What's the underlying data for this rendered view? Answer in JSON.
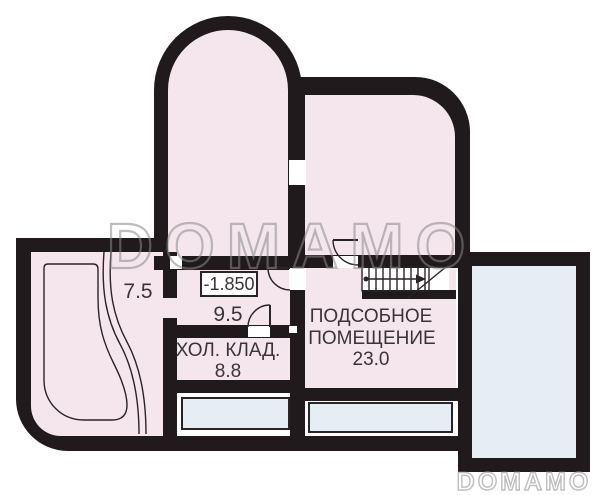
{
  "plan": {
    "type": "basement-floor-plan",
    "elevation_mark": "-1.850",
    "rooms": [
      {
        "id": "room-7-5",
        "area": "7.5"
      },
      {
        "id": "hall",
        "area": "9.5"
      },
      {
        "id": "cold-storage",
        "label": "ХОЛ. КЛАД.",
        "area": "8.8"
      },
      {
        "id": "utility-room",
        "label_line1": "ПОДСОБНОЕ",
        "label_line2": "ПОМЕЩЕНИЕ",
        "area": "23.0"
      }
    ]
  },
  "watermarks": {
    "center": "DOMAMO",
    "corner": "DOMAMO"
  },
  "colors": {
    "wall": "#201a1c",
    "room_fill": "#f5e6ed",
    "terrace_fill": "#e6edf3",
    "line": "#2a2427",
    "text": "#3b3437",
    "watermark_center": "#8a8a8a",
    "watermark_corner": "#b3b3b3",
    "background": "#ffffff"
  }
}
